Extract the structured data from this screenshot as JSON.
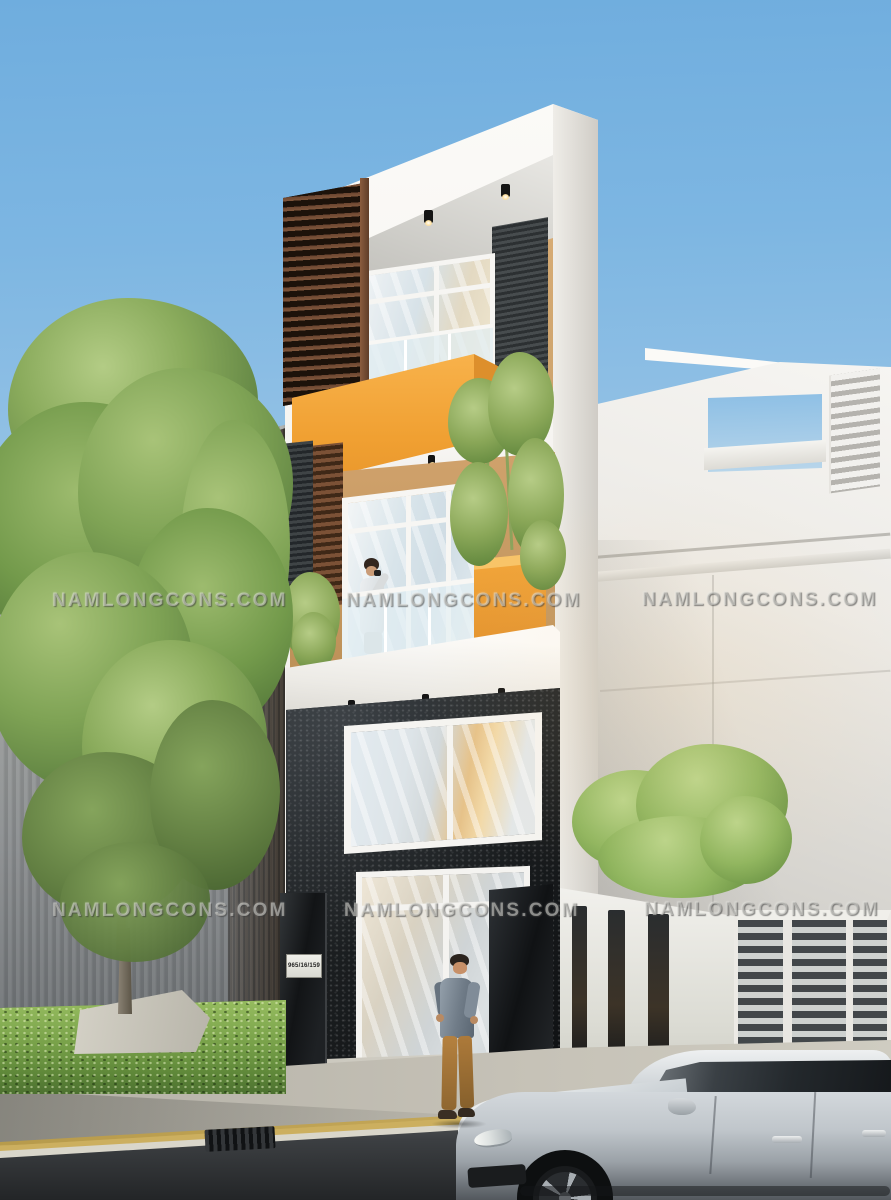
{
  "watermark": {
    "text": "NAMLONGCONS.COM"
  },
  "house": {
    "address_plate": "965/16/159"
  },
  "palette": {
    "sky_top": "#6FADDE",
    "sky_horizon": "#E8E6DD",
    "accent_orange": "#F0A032",
    "wood_brown": "#7E5238",
    "stone_dark": "#1B1E20",
    "hedge_green": "#7FAE4E",
    "concrete_gray": "#9DA09E",
    "car_silver": "#CDD3D7"
  }
}
